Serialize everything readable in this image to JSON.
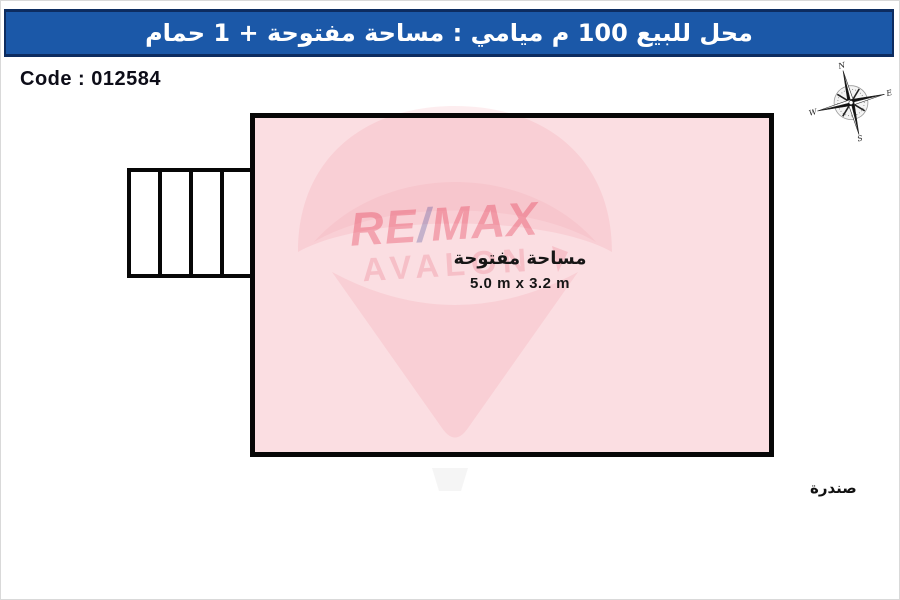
{
  "header": {
    "title": "محل للبيع 100 م ميامي : مساحة مفتوحة + 1 حمام",
    "bg_color": "#1b58a8",
    "border_color": "#0d2c60",
    "text_color": "#ffffff"
  },
  "code": {
    "label": "Code : 012584"
  },
  "compass": {
    "north": "N",
    "east": "E",
    "south": "S",
    "west": "W"
  },
  "floor_plan": {
    "room": {
      "name": "مساحة مفتوحة",
      "dimensions": "5.0 m x 3.2 m",
      "fill_color": "#fbdee2",
      "wall_color": "#070707"
    },
    "stairs": {
      "treads": 4
    },
    "loft_label": "صندرة"
  },
  "watermark": {
    "line1_left": "RE",
    "line1_slash": "/",
    "line1_right": "MAX",
    "line2": "AVALON",
    "red_color": "#f3aab6",
    "slash_color": "#8d89b0",
    "light_color": "#f7c6cf"
  }
}
